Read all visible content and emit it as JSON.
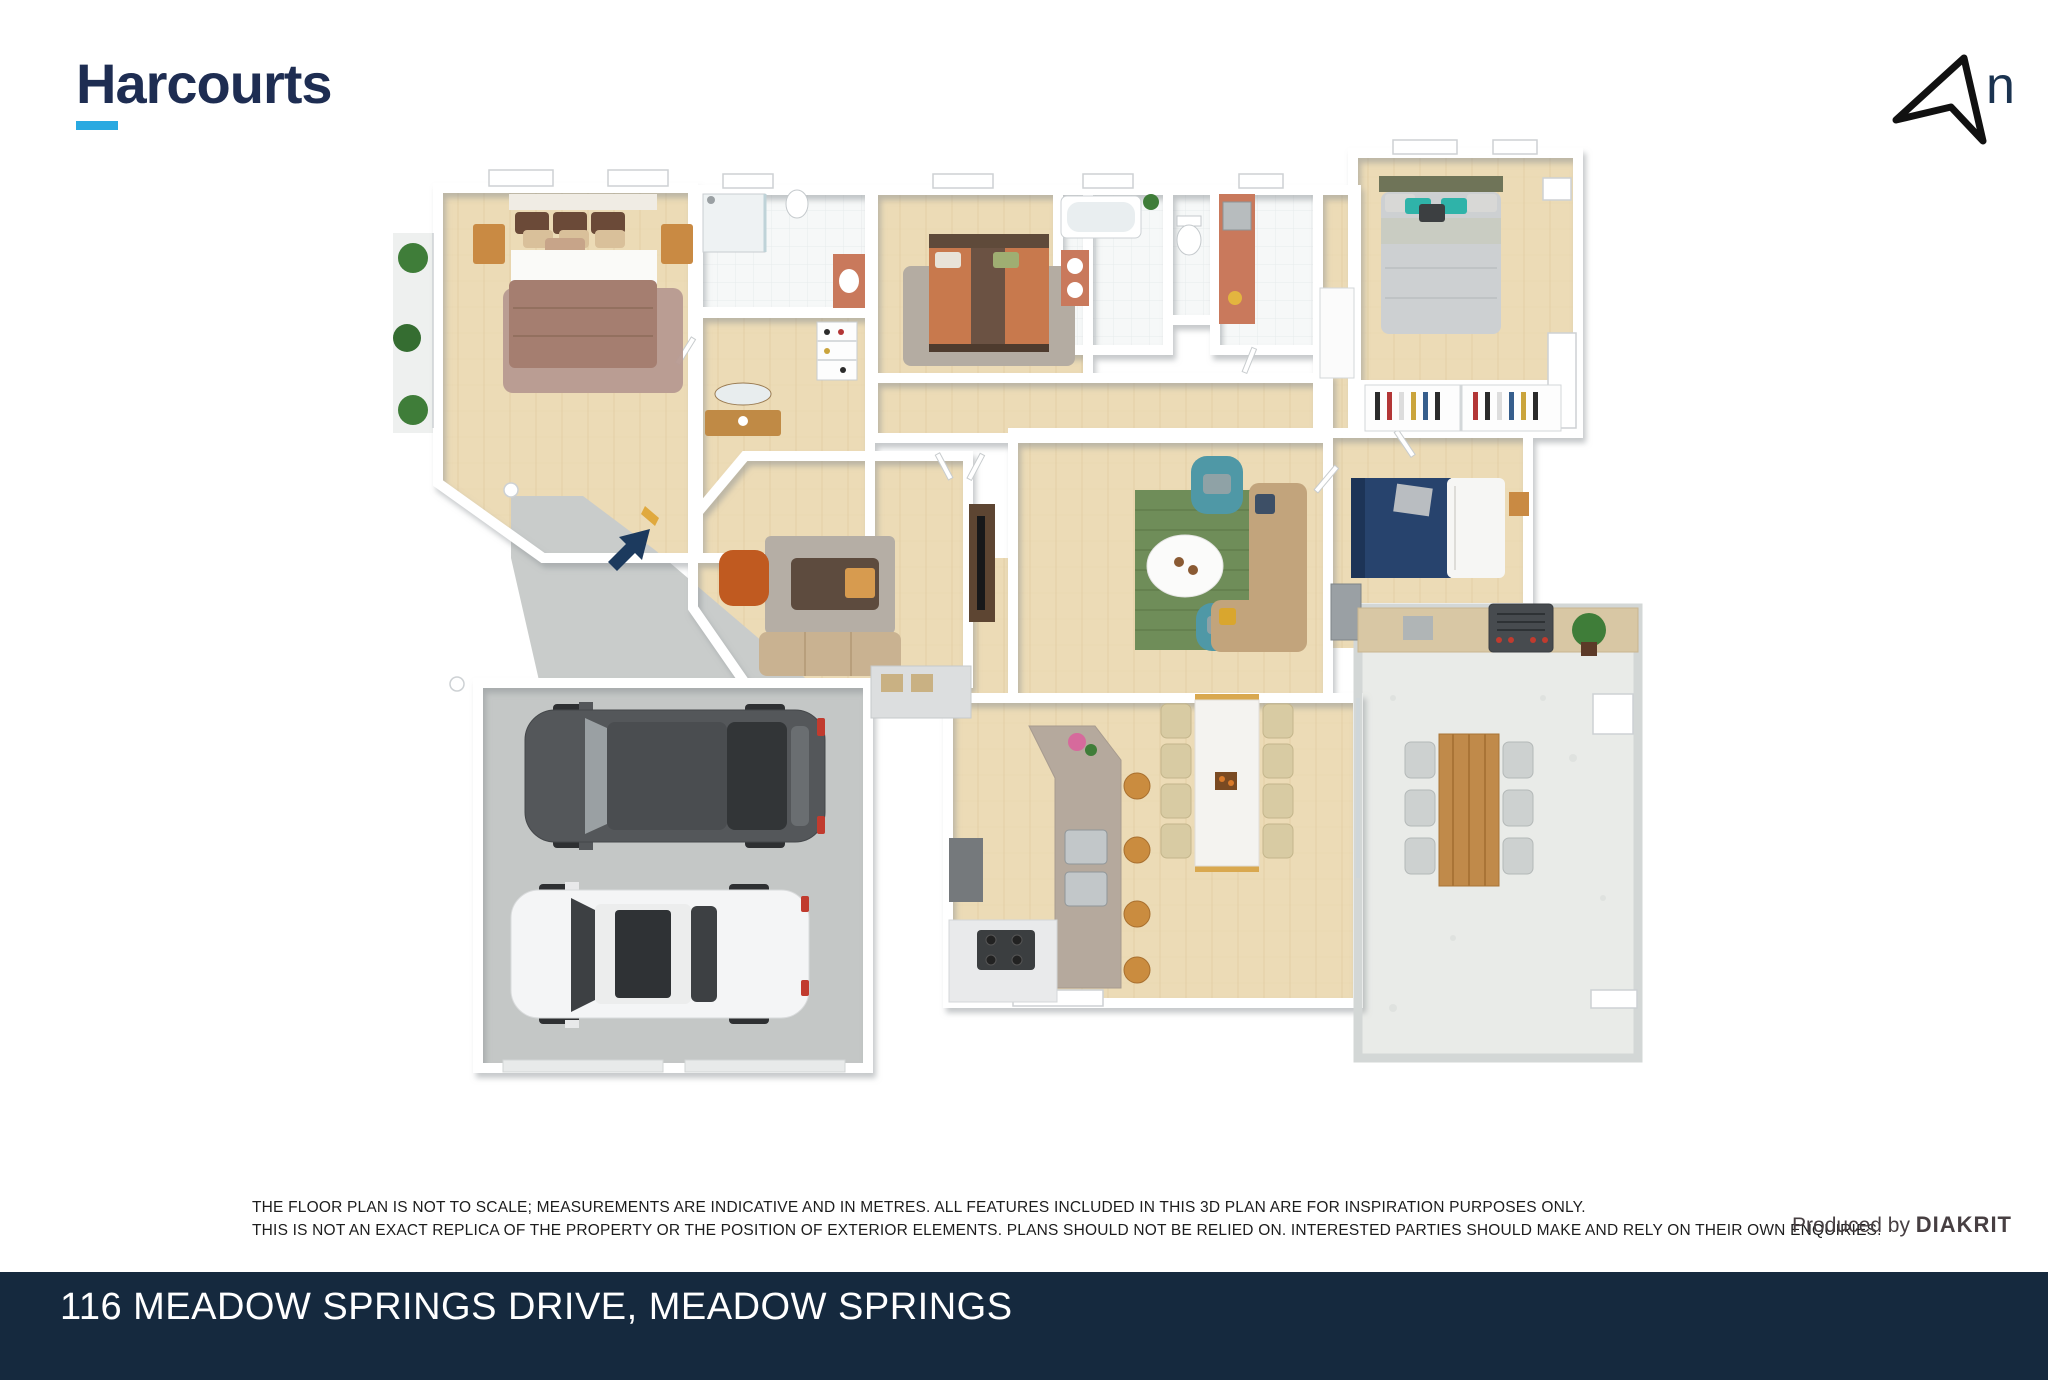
{
  "header": {
    "brand": "Harcourts",
    "north_label": "n"
  },
  "palette": {
    "brand_navy": "#1e2d52",
    "brand_cyan": "#29a9e1",
    "footer_navy": "#15293e",
    "entry_arrow_navy": "#1c3a5e",
    "floor_wood": "#ecdbb6",
    "garage_concrete": "#c4c7c6",
    "alfresco_concrete": "#e9ebe8",
    "rug_green": "#6f8d59",
    "armchair_teal": "#4f98a6",
    "bed_navy": "#27436d",
    "bed_brown_mauve": "#a57e70",
    "bed_orange": "#c8794d",
    "timber": "#c98a3f",
    "taillight_red": "#c13b2e"
  },
  "disclaimer": {
    "line1": "THE FLOOR PLAN IS NOT TO SCALE; MEASUREMENTS ARE INDICATIVE AND IN METRES. ALL FEATURES INCLUDED IN THIS 3D PLAN ARE FOR INSPIRATION PURPOSES ONLY.",
    "line2": "THIS IS NOT AN EXACT REPLICA OF THE PROPERTY OR THE POSITION OF EXTERIOR ELEMENTS. PLANS SHOULD NOT BE RELIED ON. INTERESTED PARTIES SHOULD MAKE AND RELY ON THEIR OWN ENQUIRIES."
  },
  "credit": {
    "prefix": "Produced by ",
    "brand": "DIAKRIT"
  },
  "footer": {
    "address": "116 MEADOW SPRINGS DRIVE, MEADOW SPRINGS"
  },
  "floorplan": {
    "type": "3d-floor-plan",
    "elements": [
      "north-arrow",
      "master-bedroom",
      "ensuite",
      "walk-in-robe",
      "hallway",
      "bedroom-2",
      "bathroom",
      "wc",
      "laundry",
      "linen",
      "bedroom-3",
      "robes",
      "bedroom-4",
      "theatre-room",
      "living-room",
      "dining-area",
      "kitchen-island",
      "cooktop",
      "butlers-pantry",
      "entry-porch",
      "entry-arrow",
      "double-garage",
      "dark-suv",
      "white-sedan",
      "alfresco",
      "bbq",
      "outdoor-dining-table",
      "plants"
    ]
  }
}
